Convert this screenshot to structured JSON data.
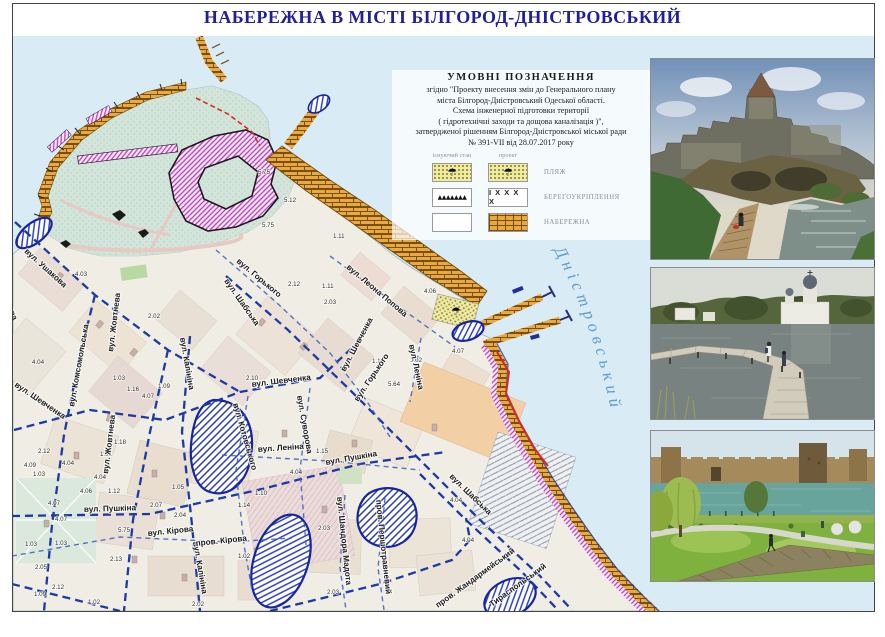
{
  "title": "НАБЕРЕЖНА В МІСТІ БІЛГОРОД-ДНІСТРОВСЬКИЙ",
  "legend": {
    "heading": "УМОВНІ  ПОЗНАЧЕННЯ",
    "lines": [
      "згідно \"Проекту внесення змін до Генерального плану",
      "міста Білгород-Дністровський Одеської області.",
      "Схема інженерної підготовки території",
      "( гідротехнічні заходи та дощова каналізація )\",",
      "затвердженої рішенням Білгород-Дністровської міської ради",
      "№ 391-VII від 28.07.2017 року"
    ],
    "columns": {
      "existing": "існуючий стан",
      "project": "проект"
    },
    "rows": [
      {
        "label": "ПЛЯЖ",
        "existing": "beach",
        "project": "beach",
        "umbrella_glyph": "☂"
      },
      {
        "label": "БЕРЕГОУКРІПЛЕННЯ",
        "existing": "triangles",
        "project": "crosses",
        "triangles_glyphs": "▲▲▲▲▲▲▲",
        "crosses_glyphs": "І Х Х Х Х"
      },
      {
        "label": "НАБЕРЕЖНА",
        "existing": "blank",
        "project": "brick"
      }
    ]
  },
  "map": {
    "water_label": "Дністровський",
    "streets": [
      {
        "t": "вул. Ушакова",
        "x": 24,
        "y": 252,
        "r": 42
      },
      {
        "t": "тузова",
        "x": 2,
        "y": 296,
        "r": 66
      },
      {
        "t": "вул. Жовтнева",
        "x": 113,
        "y": 352,
        "r": -83
      },
      {
        "t": "вул. Жовтнева",
        "x": 108,
        "y": 474,
        "r": -83
      },
      {
        "t": "вул. Комсомольська",
        "x": 74,
        "y": 407,
        "r": -80
      },
      {
        "t": "вул. Калініна",
        "x": 180,
        "y": 338,
        "r": 80
      },
      {
        "t": "вул. Калініна",
        "x": 193,
        "y": 542,
        "r": 80
      },
      {
        "t": "вул. Шевченка",
        "x": 14,
        "y": 386,
        "r": 34
      },
      {
        "t": "вул. Шевченка",
        "x": 252,
        "y": 387,
        "r": -7
      },
      {
        "t": "вул. Шевченка",
        "x": 345,
        "y": 372,
        "r": -62
      },
      {
        "t": "вул. Горького",
        "x": 236,
        "y": 262,
        "r": 40
      },
      {
        "t": "вул. Горького",
        "x": 358,
        "y": 402,
        "r": -56
      },
      {
        "t": "вул. Леона Попова",
        "x": 346,
        "y": 268,
        "r": 40
      },
      {
        "t": "вул. Шабська",
        "x": 224,
        "y": 281,
        "r": 55
      },
      {
        "t": "вул. Шабська",
        "x": 449,
        "y": 477,
        "r": 44
      },
      {
        "t": "вул. Леніна",
        "x": 409,
        "y": 345,
        "r": 78
      },
      {
        "t": "вул. Леніна",
        "x": 258,
        "y": 452,
        "r": -4
      },
      {
        "t": "вул. Суворова",
        "x": 297,
        "y": 396,
        "r": 80
      },
      {
        "t": "вул. Котовського",
        "x": 233,
        "y": 404,
        "r": 74
      },
      {
        "t": "вул. Пушкіна",
        "x": 326,
        "y": 465,
        "r": -10
      },
      {
        "t": "вул. Пушкіна",
        "x": 84,
        "y": 512,
        "r": -2
      },
      {
        "t": "вул. Кірова",
        "x": 148,
        "y": 536,
        "r": -6
      },
      {
        "t": "пров. Кірова",
        "x": 196,
        "y": 546,
        "r": -6
      },
      {
        "t": "вул. Шандора Мадота",
        "x": 337,
        "y": 497,
        "r": 84
      },
      {
        "t": "пров. Першотравневий",
        "x": 376,
        "y": 500,
        "r": 84
      },
      {
        "t": "пров. Жандармейський",
        "x": 438,
        "y": 608,
        "r": -36
      },
      {
        "t": "Тираспольський",
        "x": 492,
        "y": 607,
        "r": -36
      }
    ],
    "elevations": [
      {
        "v": "4.03",
        "x": 75,
        "y": 276
      },
      {
        "v": "2.02",
        "x": 148,
        "y": 318
      },
      {
        "v": "4.04",
        "x": 32,
        "y": 364
      },
      {
        "v": "1.03",
        "x": 113,
        "y": 380
      },
      {
        "v": "1.09",
        "x": 158,
        "y": 388
      },
      {
        "v": "4.07",
        "x": 142,
        "y": 398
      },
      {
        "v": "1.16",
        "x": 127,
        "y": 391
      },
      {
        "v": "1.18",
        "x": 114,
        "y": 444
      },
      {
        "v": "1.01",
        "x": 100,
        "y": 456
      },
      {
        "v": "2.12",
        "x": 38,
        "y": 453
      },
      {
        "v": "4.09",
        "x": 24,
        "y": 467
      },
      {
        "v": "1.03",
        "x": 33,
        "y": 476
      },
      {
        "v": "4.04",
        "x": 62,
        "y": 465
      },
      {
        "v": "4.04",
        "x": 94,
        "y": 479
      },
      {
        "v": "2.12",
        "x": 288,
        "y": 286
      },
      {
        "v": "1.11",
        "x": 322,
        "y": 288
      },
      {
        "v": "2.03",
        "x": 324,
        "y": 304
      },
      {
        "v": "4.06",
        "x": 424,
        "y": 293
      },
      {
        "v": "1.16",
        "x": 372,
        "y": 363
      },
      {
        "v": "1.02",
        "x": 410,
        "y": 362
      },
      {
        "v": "5.64",
        "x": 388,
        "y": 386
      },
      {
        "v": "2.10",
        "x": 246,
        "y": 380
      },
      {
        "v": "1.15",
        "x": 316,
        "y": 453
      },
      {
        "v": "4.04",
        "x": 290,
        "y": 474
      },
      {
        "v": "5.75",
        "x": 258,
        "y": 174
      },
      {
        "v": "5.12",
        "x": 284,
        "y": 202
      },
      {
        "v": "5.75",
        "x": 262,
        "y": 227
      },
      {
        "v": "1.11",
        "x": 333,
        "y": 238
      },
      {
        "v": "4.07",
        "x": 48,
        "y": 505
      },
      {
        "v": "4.07",
        "x": 55,
        "y": 521
      },
      {
        "v": "2.07",
        "x": 150,
        "y": 507
      },
      {
        "v": "2.04",
        "x": 174,
        "y": 517
      },
      {
        "v": "5.75",
        "x": 118,
        "y": 532
      },
      {
        "v": "1.03",
        "x": 25,
        "y": 546
      },
      {
        "v": "1.03",
        "x": 55,
        "y": 545
      },
      {
        "v": "2.05",
        "x": 35,
        "y": 569
      },
      {
        "v": "2.12",
        "x": 52,
        "y": 589
      },
      {
        "v": "1.09",
        "x": 34,
        "y": 596
      },
      {
        "v": "1.02",
        "x": 88,
        "y": 604
      },
      {
        "v": "2.13",
        "x": 110,
        "y": 561
      },
      {
        "v": "2.02",
        "x": 192,
        "y": 606
      },
      {
        "v": "1.10",
        "x": 255,
        "y": 495
      },
      {
        "v": "1.14",
        "x": 238,
        "y": 507
      },
      {
        "v": "2.03",
        "x": 318,
        "y": 530
      },
      {
        "v": "1.02",
        "x": 238,
        "y": 558
      },
      {
        "v": "2.03",
        "x": 327,
        "y": 594
      },
      {
        "v": "4.04",
        "x": 450,
        "y": 502
      },
      {
        "v": "4.04",
        "x": 462,
        "y": 542
      },
      {
        "v": "4.07",
        "x": 452,
        "y": 353
      },
      {
        "v": "1.12",
        "x": 108,
        "y": 493
      },
      {
        "v": "1.05",
        "x": 172,
        "y": 489
      },
      {
        "v": "4.06",
        "x": 80,
        "y": 493
      }
    ]
  },
  "photos": [
    {
      "id": "photo-fortress",
      "desc": "fortress on cliff with boardwalk and water"
    },
    {
      "id": "photo-pier",
      "desc": "wooden pier on liman with church on hill"
    },
    {
      "id": "photo-embankment",
      "desc": "embankment park lawns with fortress across water"
    }
  ],
  "colors": {
    "title": "#20209a",
    "water": "#d9ebf4",
    "embankment_brick": "#e8aa3f",
    "beach_yellow": "#efe9ae",
    "flood_hatch_blue": "#2b3bbd",
    "shore_magenta": "#cb3ecb",
    "street_dash_blue": "#1c3aa2",
    "red_line": "#d32b20"
  }
}
